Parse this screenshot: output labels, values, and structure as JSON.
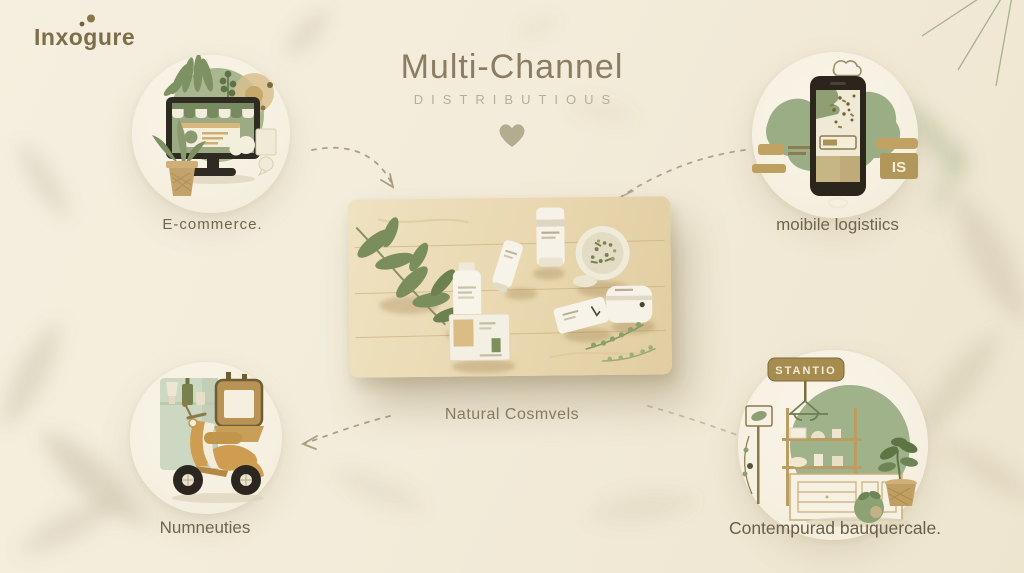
{
  "logo": {
    "text": "Inxogure"
  },
  "header": {
    "title": "Multi-Channel",
    "subtitle": "DISTRIBUTIOUS"
  },
  "center": {
    "label": "Natural Cosmvels"
  },
  "channels": [
    {
      "id": "ecommerce",
      "label": "E-commerce."
    },
    {
      "id": "mobile-logistics",
      "label": "moibile logistiics",
      "badge": "IS"
    },
    {
      "id": "delivery",
      "label": "Numneuties"
    },
    {
      "id": "retail",
      "label": "Contempurad bauquercale.",
      "sign": "STANTIO"
    }
  ],
  "icons": {
    "ecommerce": "desktop-storefront-icon",
    "mobile": "smartphone-cloud-icon",
    "delivery": "delivery-scooter-icon",
    "retail": "store-shelf-icon",
    "divider": "heart-icon",
    "corner": "palm-leaf-icon"
  },
  "colors": {
    "background": "#f3ecda",
    "sage": "#9fb28a",
    "tan": "#c1a263",
    "dark_frame": "#2b251c",
    "text_dark": "#6f654c",
    "text_muted": "#b5ae9c",
    "leaf_dark": "#4c5f38",
    "wood": "#e8d8af"
  }
}
